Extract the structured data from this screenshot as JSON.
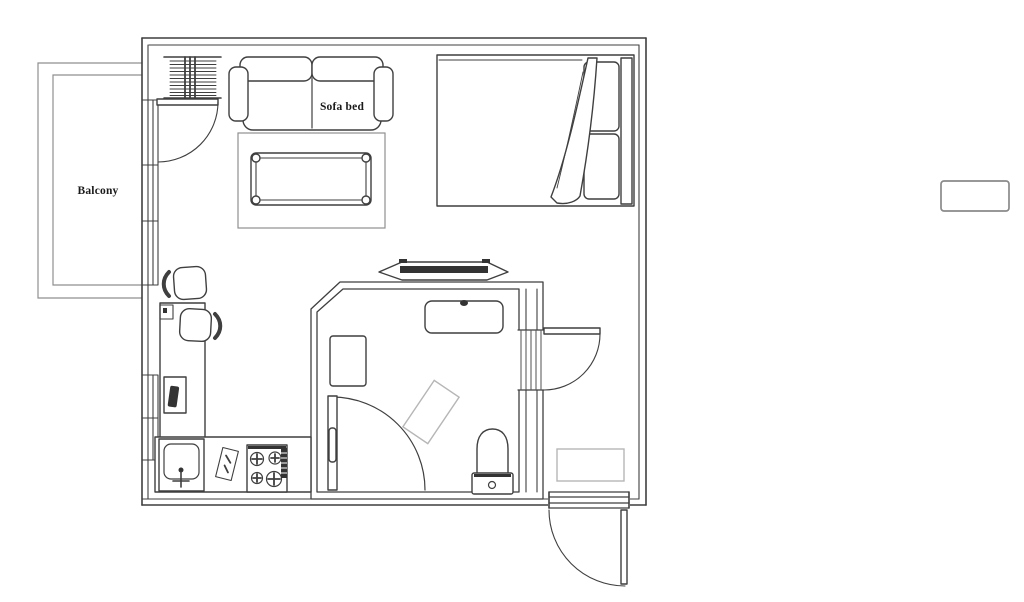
{
  "labels": {
    "balcony": "Balcony",
    "sofa_bed": "Sofa bed"
  },
  "colors": {
    "wall": "#3f3f3f",
    "light": "#8f8f8f",
    "dark": "#333333",
    "mat": "#b6b6b6",
    "text": "#1a1a1a",
    "bg": "#ffffff"
  }
}
